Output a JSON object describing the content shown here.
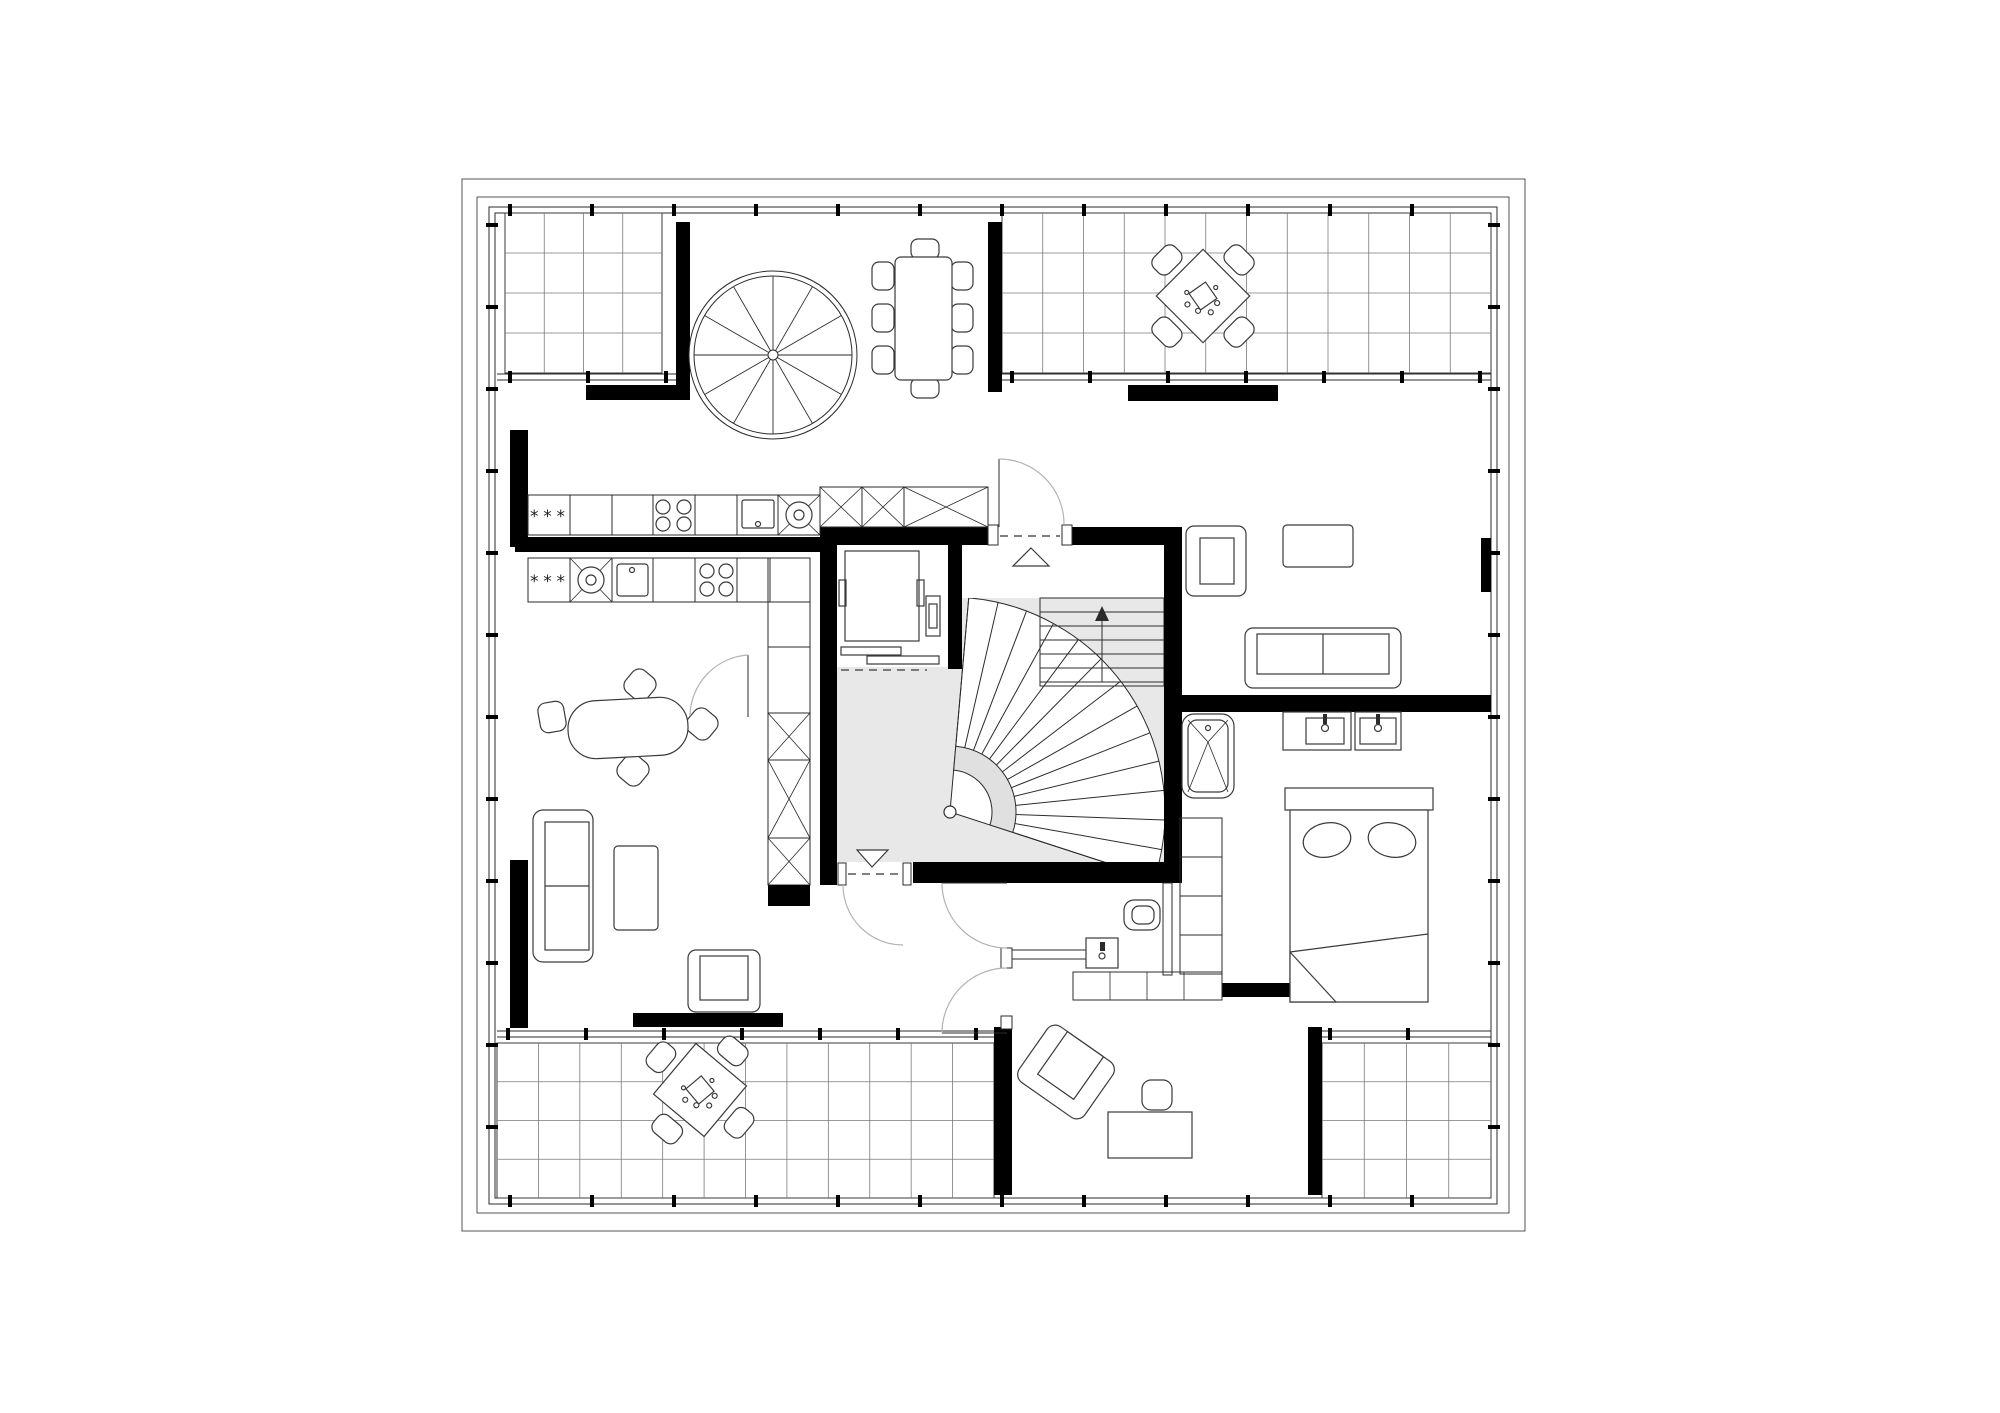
{
  "document": {
    "type": "architectural floor plan",
    "view": "top-down CAD drawing",
    "style": "monochrome linework, filled black walls, tiled terraces",
    "level": "attic floor with two units, elevator, spiral stair and curved stair"
  },
  "colors": {
    "background": "#ffffff",
    "line": "#2b2b2b",
    "wall_fill": "#000000",
    "tile_line": "#7a7a7a",
    "terrace_border": "#3a3a3a",
    "stair_zone_fill": "#e8e8e8",
    "stair_band_fill": "#e0e0e0",
    "door_arc": "#b3b3b3"
  },
  "labels": {
    "freezer_upper": "***",
    "freezer_lower": "***"
  },
  "terraces": [
    {
      "name": "terrace-top-left-grid",
      "x": 505,
      "y": 213,
      "w": 157,
      "h": 160,
      "cols": 4,
      "rows": 4
    },
    {
      "name": "terrace-top-right-grid",
      "x": 1002,
      "y": 213,
      "w": 489,
      "h": 160,
      "cols": 12,
      "rows": 4
    },
    {
      "name": "terrace-bottom-left-grid",
      "x": 497,
      "y": 1043,
      "w": 497,
      "h": 155,
      "cols": 12,
      "rows": 4
    },
    {
      "name": "terrace-bottom-right-grid",
      "x": 1322,
      "y": 1043,
      "w": 169,
      "h": 155,
      "cols": 4,
      "rows": 4
    }
  ],
  "window_bands": [
    {
      "name": "glazing-terrace-top-left-bottom",
      "o": "h",
      "c": 377,
      "a1": 497,
      "a2": 676
    },
    {
      "name": "glazing-terrace-top-right-bottom",
      "o": "h",
      "c": 377,
      "a1": 1002,
      "a2": 1491
    },
    {
      "name": "glazing-terrace-bottom-left-top",
      "o": "h",
      "c": 1034,
      "a1": 497,
      "a2": 994
    },
    {
      "name": "glazing-terrace-bottom-right-top",
      "o": "h",
      "c": 1034,
      "a1": 1322,
      "a2": 1491
    }
  ],
  "window_ticks": [
    {
      "name": "ticks-top",
      "o": "h",
      "c": 210,
      "a1": 510,
      "a2": 1480,
      "step": 82
    },
    {
      "name": "ticks-bottom",
      "o": "h",
      "c": 1201,
      "a1": 510,
      "a2": 1480,
      "step": 82
    },
    {
      "name": "ticks-left",
      "o": "v",
      "c": 492,
      "a1": 225,
      "a2": 1190,
      "step": 82
    },
    {
      "name": "ticks-right",
      "o": "v",
      "c": 1494,
      "a1": 225,
      "a2": 1190,
      "step": 82
    },
    {
      "name": "ticks-t1b",
      "o": "h",
      "c": 377,
      "a1": 510,
      "a2": 668,
      "step": 78
    },
    {
      "name": "ticks-t2b",
      "o": "h",
      "c": 377,
      "a1": 1012,
      "a2": 1482,
      "step": 78
    },
    {
      "name": "ticks-t3t",
      "o": "h",
      "c": 1034,
      "a1": 508,
      "a2": 986,
      "step": 78
    },
    {
      "name": "ticks-t4t",
      "o": "h",
      "c": 1034,
      "a1": 1330,
      "a2": 1484,
      "step": 78
    }
  ],
  "spiral_stair": {
    "cx": 773,
    "cy": 355,
    "r_outer": 84,
    "r_mid": 79,
    "hub_r": 5,
    "radii": 12
  },
  "curved_stair": {
    "cx": 950,
    "cy": 812,
    "r_in": 42,
    "r_band": 66,
    "r_out": 215,
    "a_start": -85,
    "a_end": 18,
    "treads": 13,
    "zone": {
      "x": 837,
      "y": 598,
      "w": 327,
      "h": 264
    }
  },
  "straight_run": {
    "x": 1040,
    "y": 598,
    "w": 124,
    "h": 88,
    "treads": 6
  },
  "elements": [
    "terrace-top-left",
    "terrace-top-right",
    "terrace-bottom-left",
    "terrace-bottom-right",
    "spiral-staircase",
    "curved-staircase",
    "straight-stair-run",
    "elevator",
    "dining-table-eight-seats",
    "terrace-table-top-right",
    "terrace-table-bottom-left",
    "kitchen-upper-counter",
    "kitchen-tall-units",
    "kitchen-lower-counter",
    "kitchen-cabinet-strip",
    "oval-dining-table",
    "sofa-left",
    "coffee-table-left",
    "armchair-left",
    "armchair-top-right",
    "coffee-table-top-right",
    "sofa-top-right",
    "double-bed",
    "bedroom-wardrobe",
    "bathtub",
    "washbasin-counter",
    "washbasin",
    "shower-tile-strip",
    "toilet",
    "wc-washbasin",
    "desk-bottom-room",
    "stool-bottom-room",
    "armchair-bottom-room",
    "entrance-door-upper",
    "landing-door-lower",
    "hall-doors",
    "elevator-door"
  ]
}
